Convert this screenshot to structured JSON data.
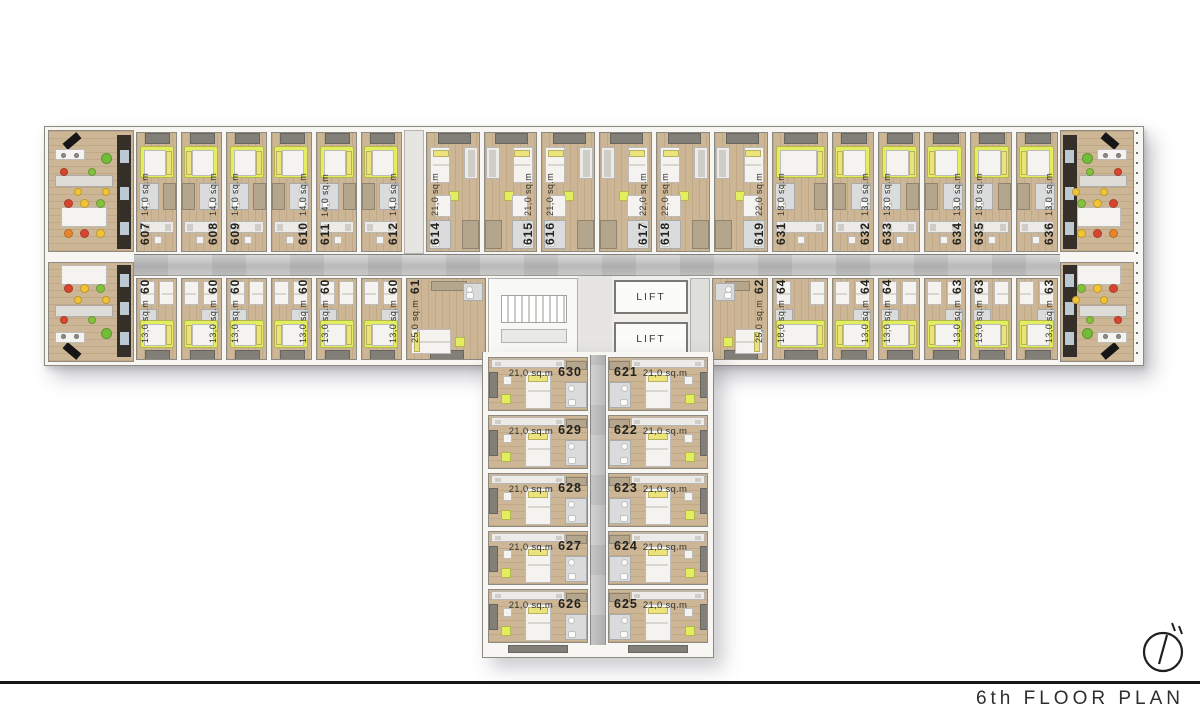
{
  "footer": {
    "title": "6th FLOOR PLAN"
  },
  "core": {
    "lift_label": "LIFT"
  },
  "rooms": {
    "top_left": [
      {
        "num": "607",
        "area": "14,0 sq.m"
      },
      {
        "num": "608",
        "area": "14,0 sq.m"
      },
      {
        "num": "609",
        "area": "14,0 sq.m"
      },
      {
        "num": "610",
        "area": "14,0 sq.m"
      },
      {
        "num": "611",
        "area": "14,0 sq.m"
      },
      {
        "num": "612",
        "area": "14,0 sq.m"
      }
    ],
    "top_mid": [
      {
        "num": "614",
        "area": "21,0 sq.m"
      },
      {
        "num": "615",
        "area": "21,0 sq.m"
      },
      {
        "num": "616",
        "area": "21,0 sq.m"
      },
      {
        "num": "617",
        "area": "22,0 sq.m"
      },
      {
        "num": "618",
        "area": "22,0 sq.m"
      },
      {
        "num": "619",
        "area": "22,0 sq.m"
      }
    ],
    "top_right": [
      {
        "num": "631",
        "area": "18,0 sq.m"
      },
      {
        "num": "632",
        "area": "13,0 sq.m"
      },
      {
        "num": "633",
        "area": "13,0 sq.m"
      },
      {
        "num": "634",
        "area": "13,0 sq.m"
      },
      {
        "num": "635",
        "area": "13,0 sq.m"
      },
      {
        "num": "636",
        "area": "13,0 sq.m"
      }
    ],
    "bottom_left": [
      {
        "num": "606",
        "area": "13,0 sq.m"
      },
      {
        "num": "605",
        "area": "13,0 sq.m"
      },
      {
        "num": "604",
        "area": "13,0 sq.m"
      },
      {
        "num": "603",
        "area": "13,0 sq.m"
      },
      {
        "num": "602",
        "area": "13,0 sq.m"
      },
      {
        "num": "601",
        "area": "13,0 sq.m"
      }
    ],
    "corner_left": {
      "num": "613",
      "area": "25,0 sq.m"
    },
    "corner_right": {
      "num": "620",
      "area": "25,0 sq.m"
    },
    "bottom_right": [
      {
        "num": "642",
        "area": "18,0 sq.m"
      },
      {
        "num": "641",
        "area": "13,0 sq.m"
      },
      {
        "num": "640",
        "area": "13,0 sq.m"
      },
      {
        "num": "639",
        "area": "13,0 sq.m"
      },
      {
        "num": "638",
        "area": "13,0 sq.m"
      },
      {
        "num": "637",
        "area": "13,0 sq.m"
      }
    ],
    "stem_rows": [
      {
        "left": {
          "num": "630",
          "area": "21,0 sq.m"
        },
        "right": {
          "num": "621",
          "area": "21,0 sq.m"
        }
      },
      {
        "left": {
          "num": "629",
          "area": "21,0 sq.m"
        },
        "right": {
          "num": "622",
          "area": "21,0 sq.m"
        }
      },
      {
        "left": {
          "num": "628",
          "area": "21,0 sq.m"
        },
        "right": {
          "num": "623",
          "area": "21,0 sq.m"
        }
      },
      {
        "left": {
          "num": "627",
          "area": "21,0 sq.m"
        },
        "right": {
          "num": "624",
          "area": "21,0 sq.m"
        }
      },
      {
        "left": {
          "num": "626",
          "area": "21,0 sq.m"
        },
        "right": {
          "num": "625",
          "area": "21,0 sq.m"
        }
      }
    ]
  },
  "colors": {
    "wood": "#cdb695",
    "accent_lime": "#e3ee5e",
    "pillow_lime": "#ece47a",
    "bath_gray": "#d9dbdd",
    "wardrobe": "#b4a68c",
    "white_furn": "#f4f3ef",
    "kitchen_dark": "#342f29",
    "kitchen_tile": "#bcc9d2",
    "chair_red": "#d8452f",
    "chair_yellow": "#f2c435",
    "chair_green": "#85c23c",
    "chair_orange": "#e8842a",
    "ball_green": "#71bd38",
    "line": "#171717"
  }
}
